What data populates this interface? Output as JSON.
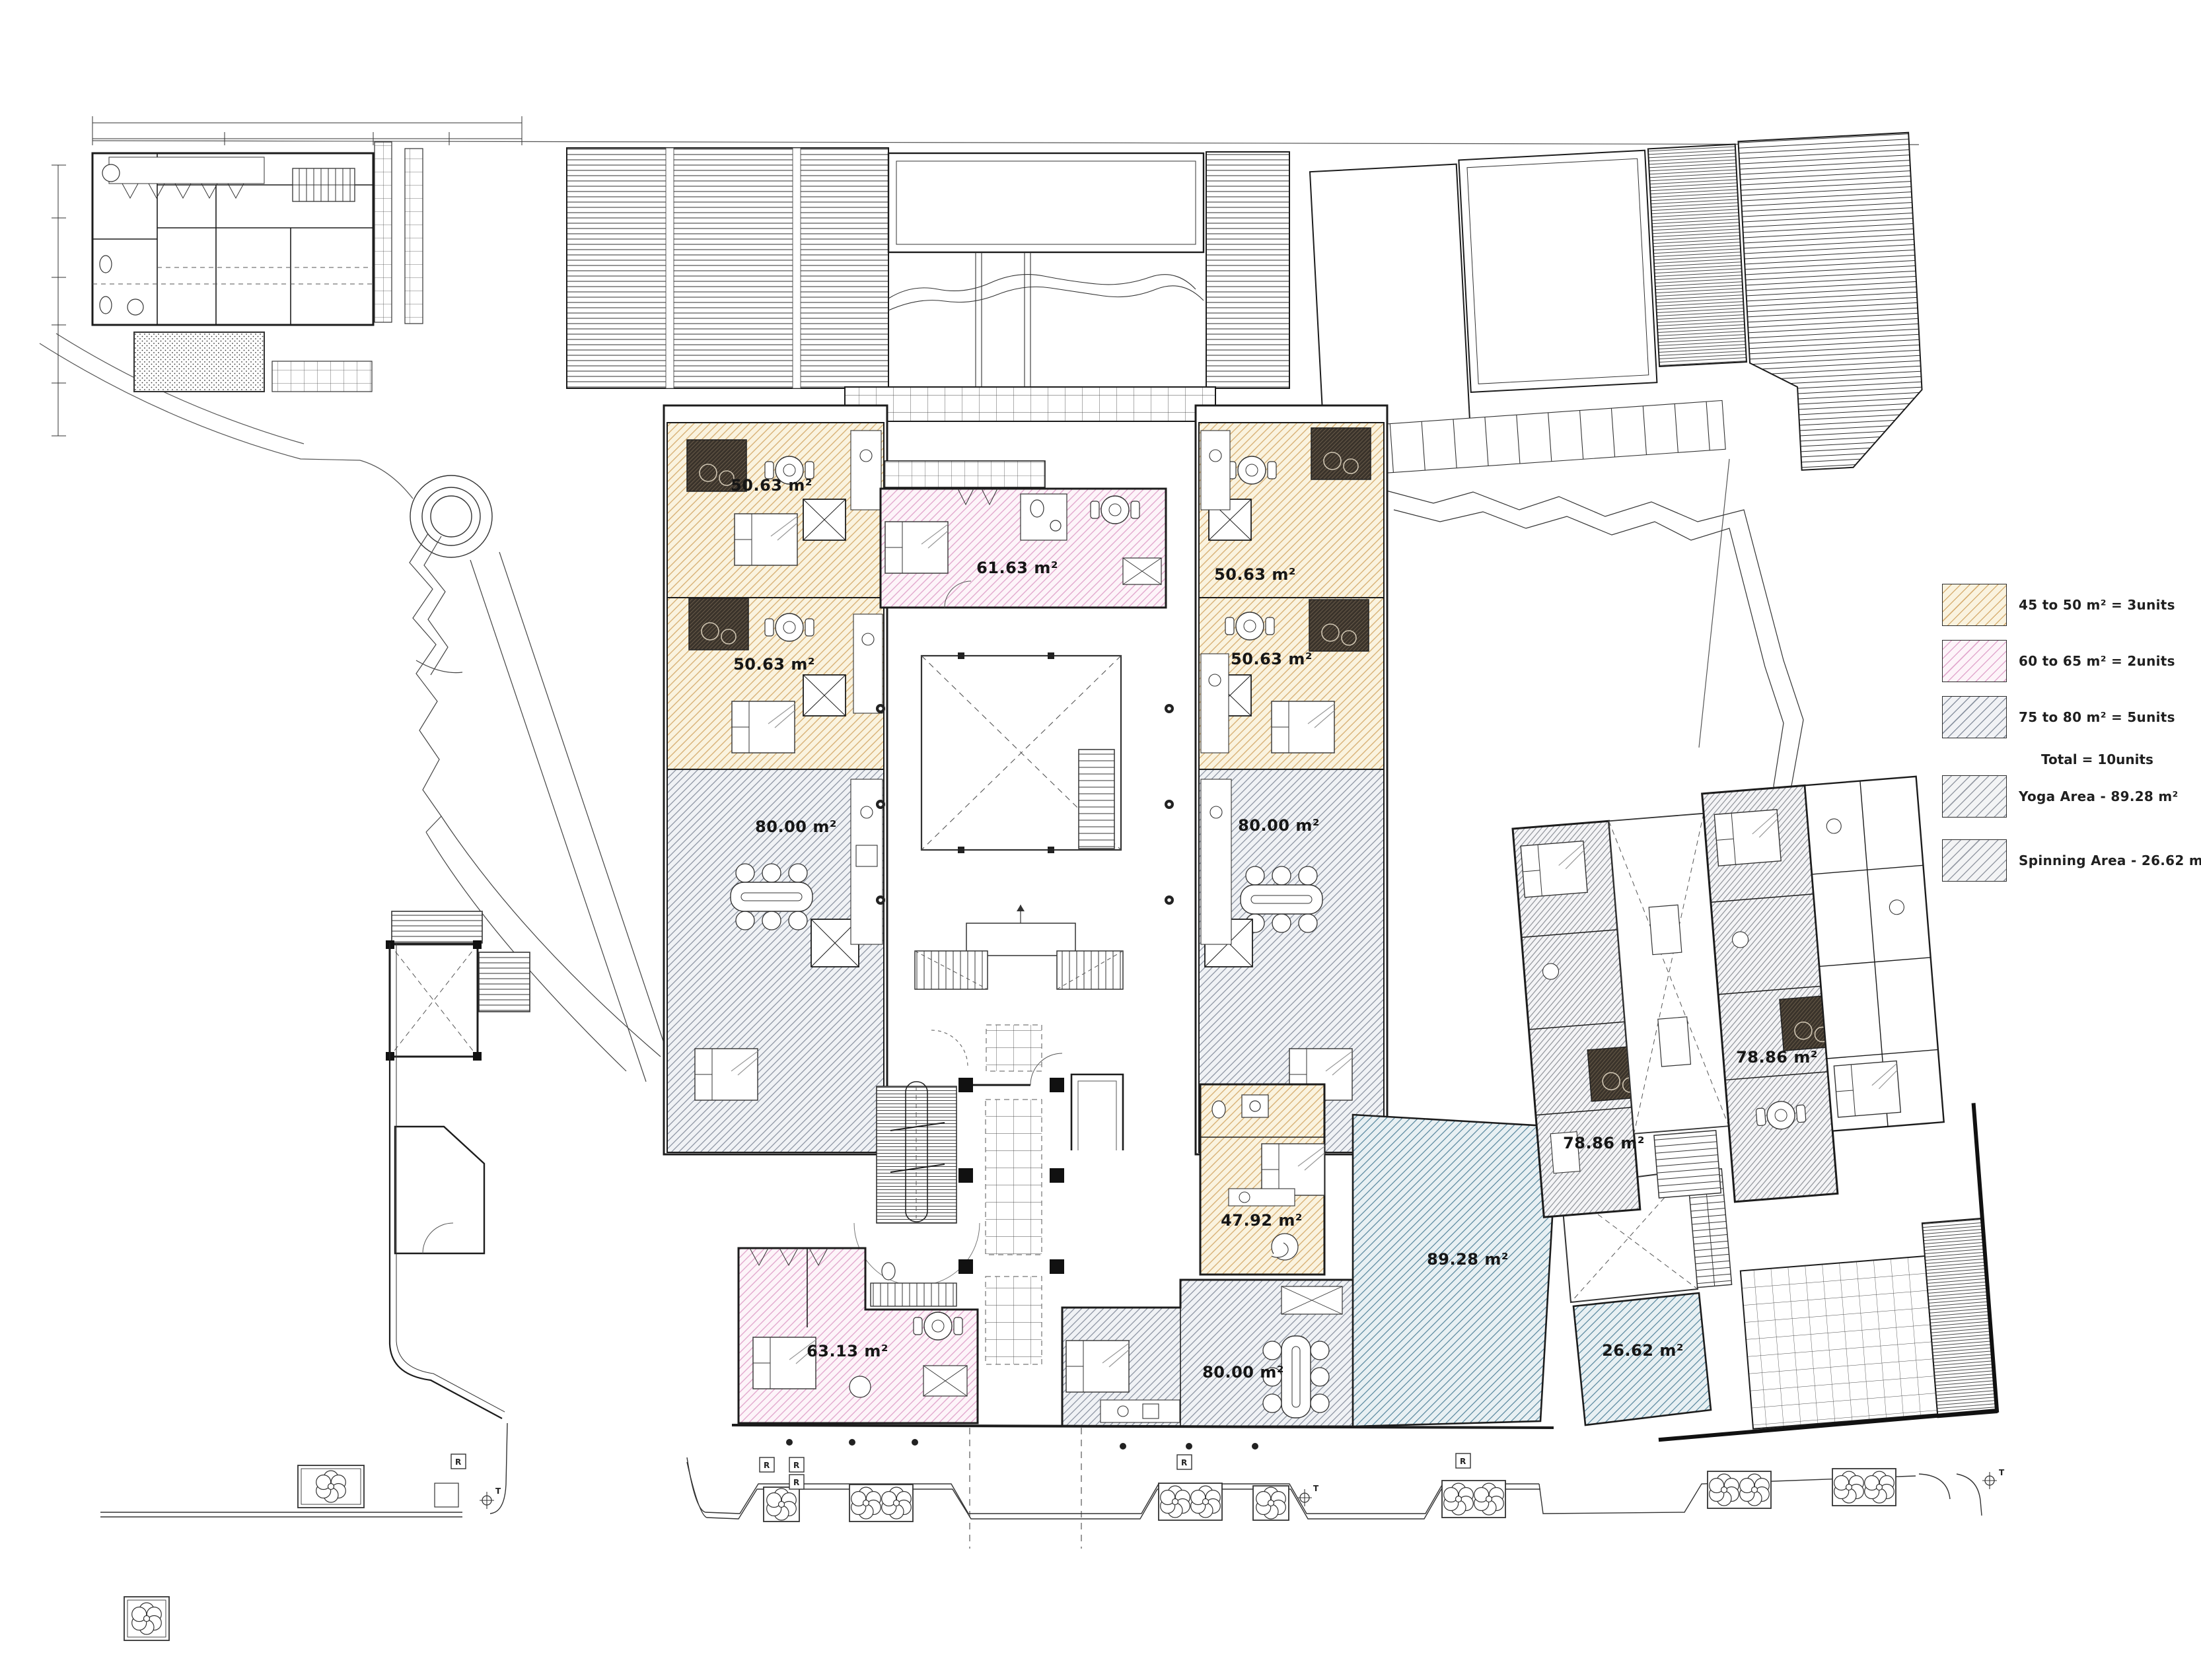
{
  "drawing": {
    "kind": "architectural floor plan with site"
  },
  "units": [
    {
      "id": "unit-left-1",
      "label": "50.63 m²"
    },
    {
      "id": "unit-left-2",
      "label": "50.63 m²"
    },
    {
      "id": "unit-left-3",
      "label": "80.00 m²"
    },
    {
      "id": "unit-center-top",
      "label": "61.63 m²"
    },
    {
      "id": "unit-right-1",
      "label": "50.63 m²"
    },
    {
      "id": "unit-right-2",
      "label": "50.63 m²"
    },
    {
      "id": "unit-right-3",
      "label": "80.00 m²"
    },
    {
      "id": "unit-bottom-pink",
      "label": "63.13 m²"
    },
    {
      "id": "unit-bottom-beige",
      "label": "47.92 m²"
    },
    {
      "id": "unit-bottom-gray",
      "label": "80.00 m²"
    },
    {
      "id": "unit-tilted-left",
      "label": "78.86 m²"
    },
    {
      "id": "unit-tilted-right",
      "label": "78.86 m²"
    },
    {
      "id": "yoga-area",
      "label": "89.28 m²"
    },
    {
      "id": "spinning-area",
      "label": "26.62 m²"
    }
  ],
  "legend": {
    "items": [
      {
        "id": "range-45-50",
        "label": "45 to 50 m² = 3units",
        "swatch_color": "#d8b176"
      },
      {
        "id": "range-60-65",
        "label": "60 to 65 m² = 2units",
        "swatch_color": "#e2a9ce"
      },
      {
        "id": "range-75-80",
        "label": "75 to 80 m² = 5units",
        "swatch_color": "#8d95a3"
      },
      {
        "id": "yoga",
        "label": "Yoga Area - 89.28 m²",
        "swatch_color": "#979ca6"
      },
      {
        "id": "spinning",
        "label": "Spinning Area - 26.62 m²",
        "swatch_color": "#979ca6"
      }
    ],
    "total_label": "Total = 10units"
  },
  "markers": {
    "ramp": "R",
    "tap": "T"
  },
  "colors": {
    "beige_bg": "#faf3df",
    "beige_line": "#d8b176",
    "pink_bg": "#fdf4f9",
    "pink_line": "#e2a9ce",
    "gray_bg": "#f0f2f5",
    "gray_line": "#8d95a3",
    "blue_bg": "#e8f0f3",
    "blue_line": "#5d8ba1",
    "wall": "#1c1c1c"
  }
}
